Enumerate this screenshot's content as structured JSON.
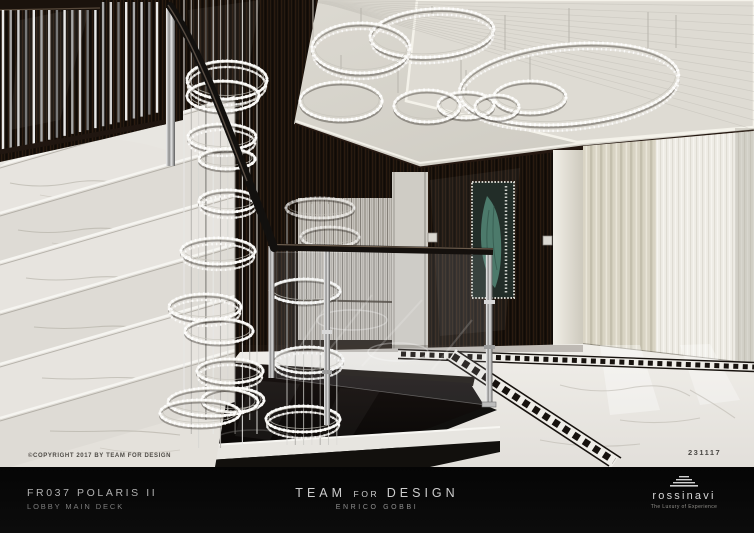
{
  "artwork": {
    "copyright_note": "©COPYRIGHT 2017 BY TEAM FOR DESIGN",
    "render_number": "231117"
  },
  "caption_bar": {
    "project": {
      "title": "FR037 POLARIS II",
      "subtitle": "LOBBY MAIN DECK"
    },
    "studio": {
      "name_parts": [
        "TEAM",
        "FOR",
        "DESIGN"
      ],
      "designer": "ENRICO GOBBI"
    },
    "brand": {
      "name": "rossinavi",
      "tagline": "The Luxury of Experience",
      "icon": "stacked-hull-lines-icon"
    }
  },
  "scene": {
    "colors": {
      "marble_light": "#e9e6e1",
      "dark_wood": "#17100b",
      "ceiling": "#d6d3cb",
      "curtain_beige": "#d9d4c4",
      "curtain_sheer": "#efede6",
      "chrome": "#c9c9c9",
      "crystal": "#f6f5f2",
      "pit_black": "#0c0a08",
      "dress_teal": "#4c7a6b",
      "caption_bg": "#0a0a0a"
    }
  }
}
